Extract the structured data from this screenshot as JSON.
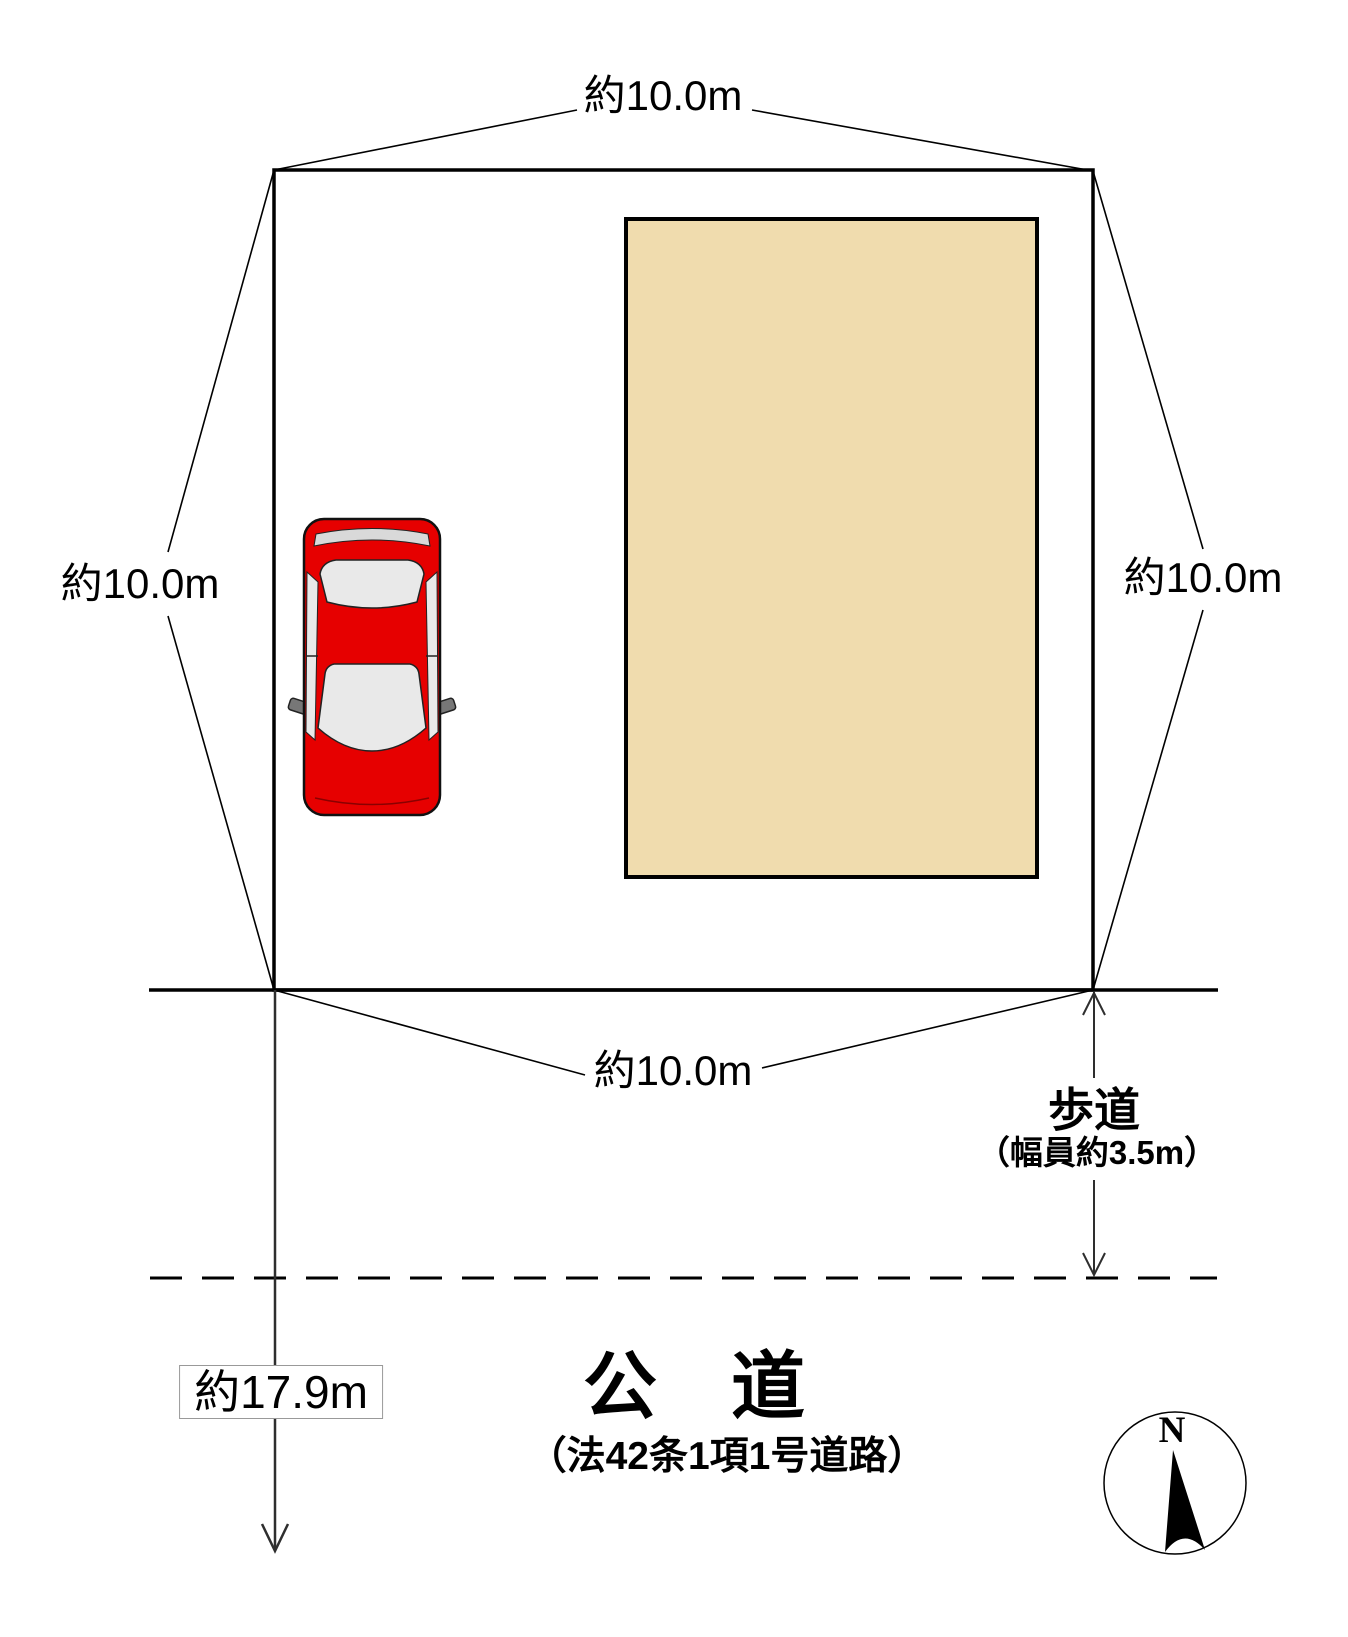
{
  "labels": {
    "dim_top": "約10.0m",
    "dim_left": "約10.0m",
    "dim_right": "約10.0m",
    "dim_bottom": "約10.0m",
    "road_depth": "約17.9m",
    "sidewalk": "歩道",
    "sidewalk_width": "（幅員約3.5m）",
    "road_name": "公　道",
    "road_classification": "（法42条1項1号道路）",
    "compass_north": "N"
  },
  "colors": {
    "building_fill": "#f0dcae",
    "car_body": "#e60000",
    "glass": "#e9e9e9",
    "line": "#000000"
  }
}
